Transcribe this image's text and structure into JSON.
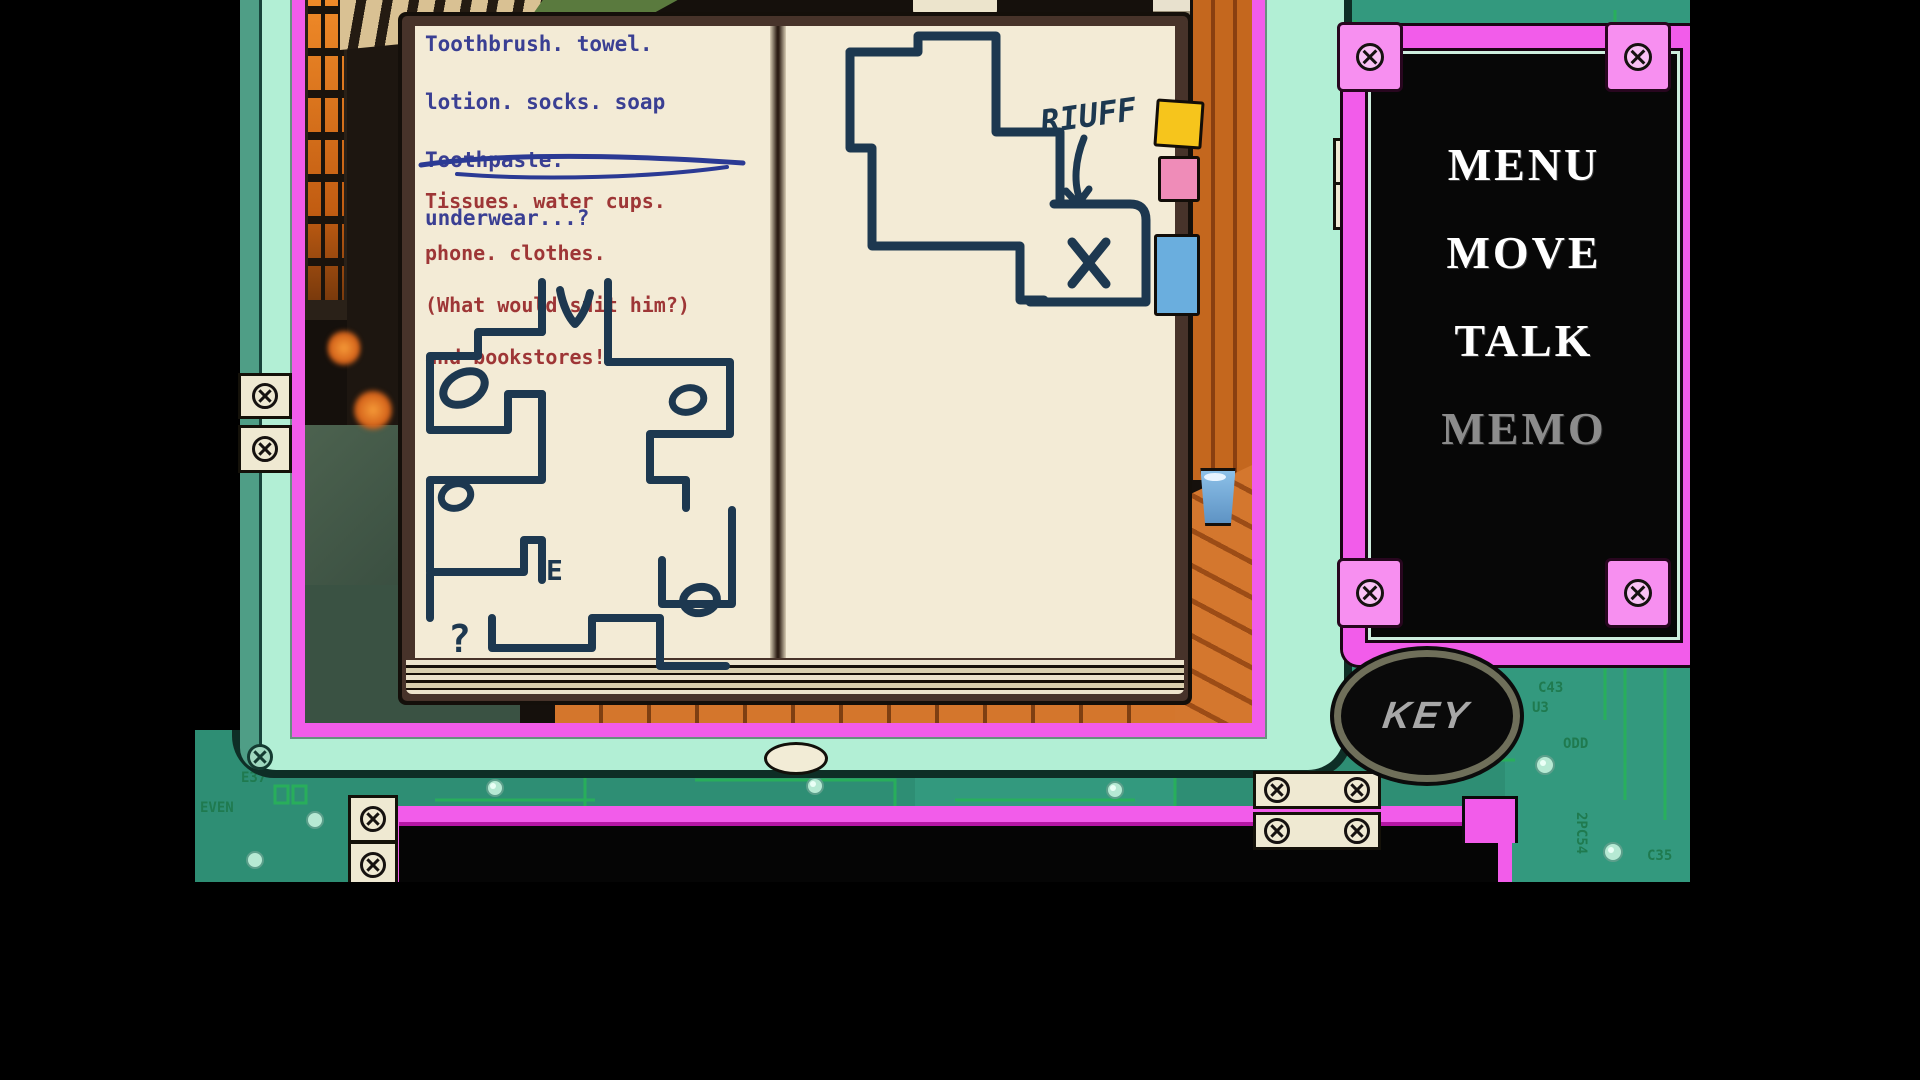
{
  "memo_device": {
    "notebook": {
      "blue_notes": [
        "Toothbrush. towel.",
        "lotion. socks. soap",
        "Toothpaste.",
        "underwear...?"
      ],
      "red_notes": [
        "Tissues. water cups.",
        "phone. clothes.",
        "(What would suit him?)",
        "and bookstores!"
      ],
      "left_map_labels": {
        "exit": "E",
        "question": "?"
      },
      "right_map_labels": {
        "annotation": "RIUFF",
        "spot_marker": "X"
      },
      "bookmark_tabs": [
        {
          "name": "yellow-tab",
          "color": "#f6c51c"
        },
        {
          "name": "pink-tab",
          "color": "#ef8cb8"
        },
        {
          "name": "blue-tab",
          "color": "#6aaede"
        }
      ]
    }
  },
  "command_menu": {
    "items": [
      {
        "label": "MENU",
        "enabled": true
      },
      {
        "label": "MOVE",
        "enabled": true
      },
      {
        "label": "TALK",
        "enabled": true
      },
      {
        "label": "MEMO",
        "enabled": false
      }
    ]
  },
  "key_button": {
    "label": "KEY"
  },
  "pcb": {
    "labels": [
      "C43",
      "U3",
      "ODD",
      "C35",
      "E37",
      "EVEN",
      "2PC54"
    ]
  },
  "colors": {
    "frame_pink": "#f25cea",
    "corner_pink": "#f78ff0",
    "bezel_mint": "#b2efd5",
    "pcb_teal": "#33997e",
    "trace_green": "#27b457",
    "ink_navy": "#1d3850",
    "note_blue": "#3a3f93",
    "note_red": "#9e3636",
    "disabled_gray": "#8c8c8c"
  }
}
